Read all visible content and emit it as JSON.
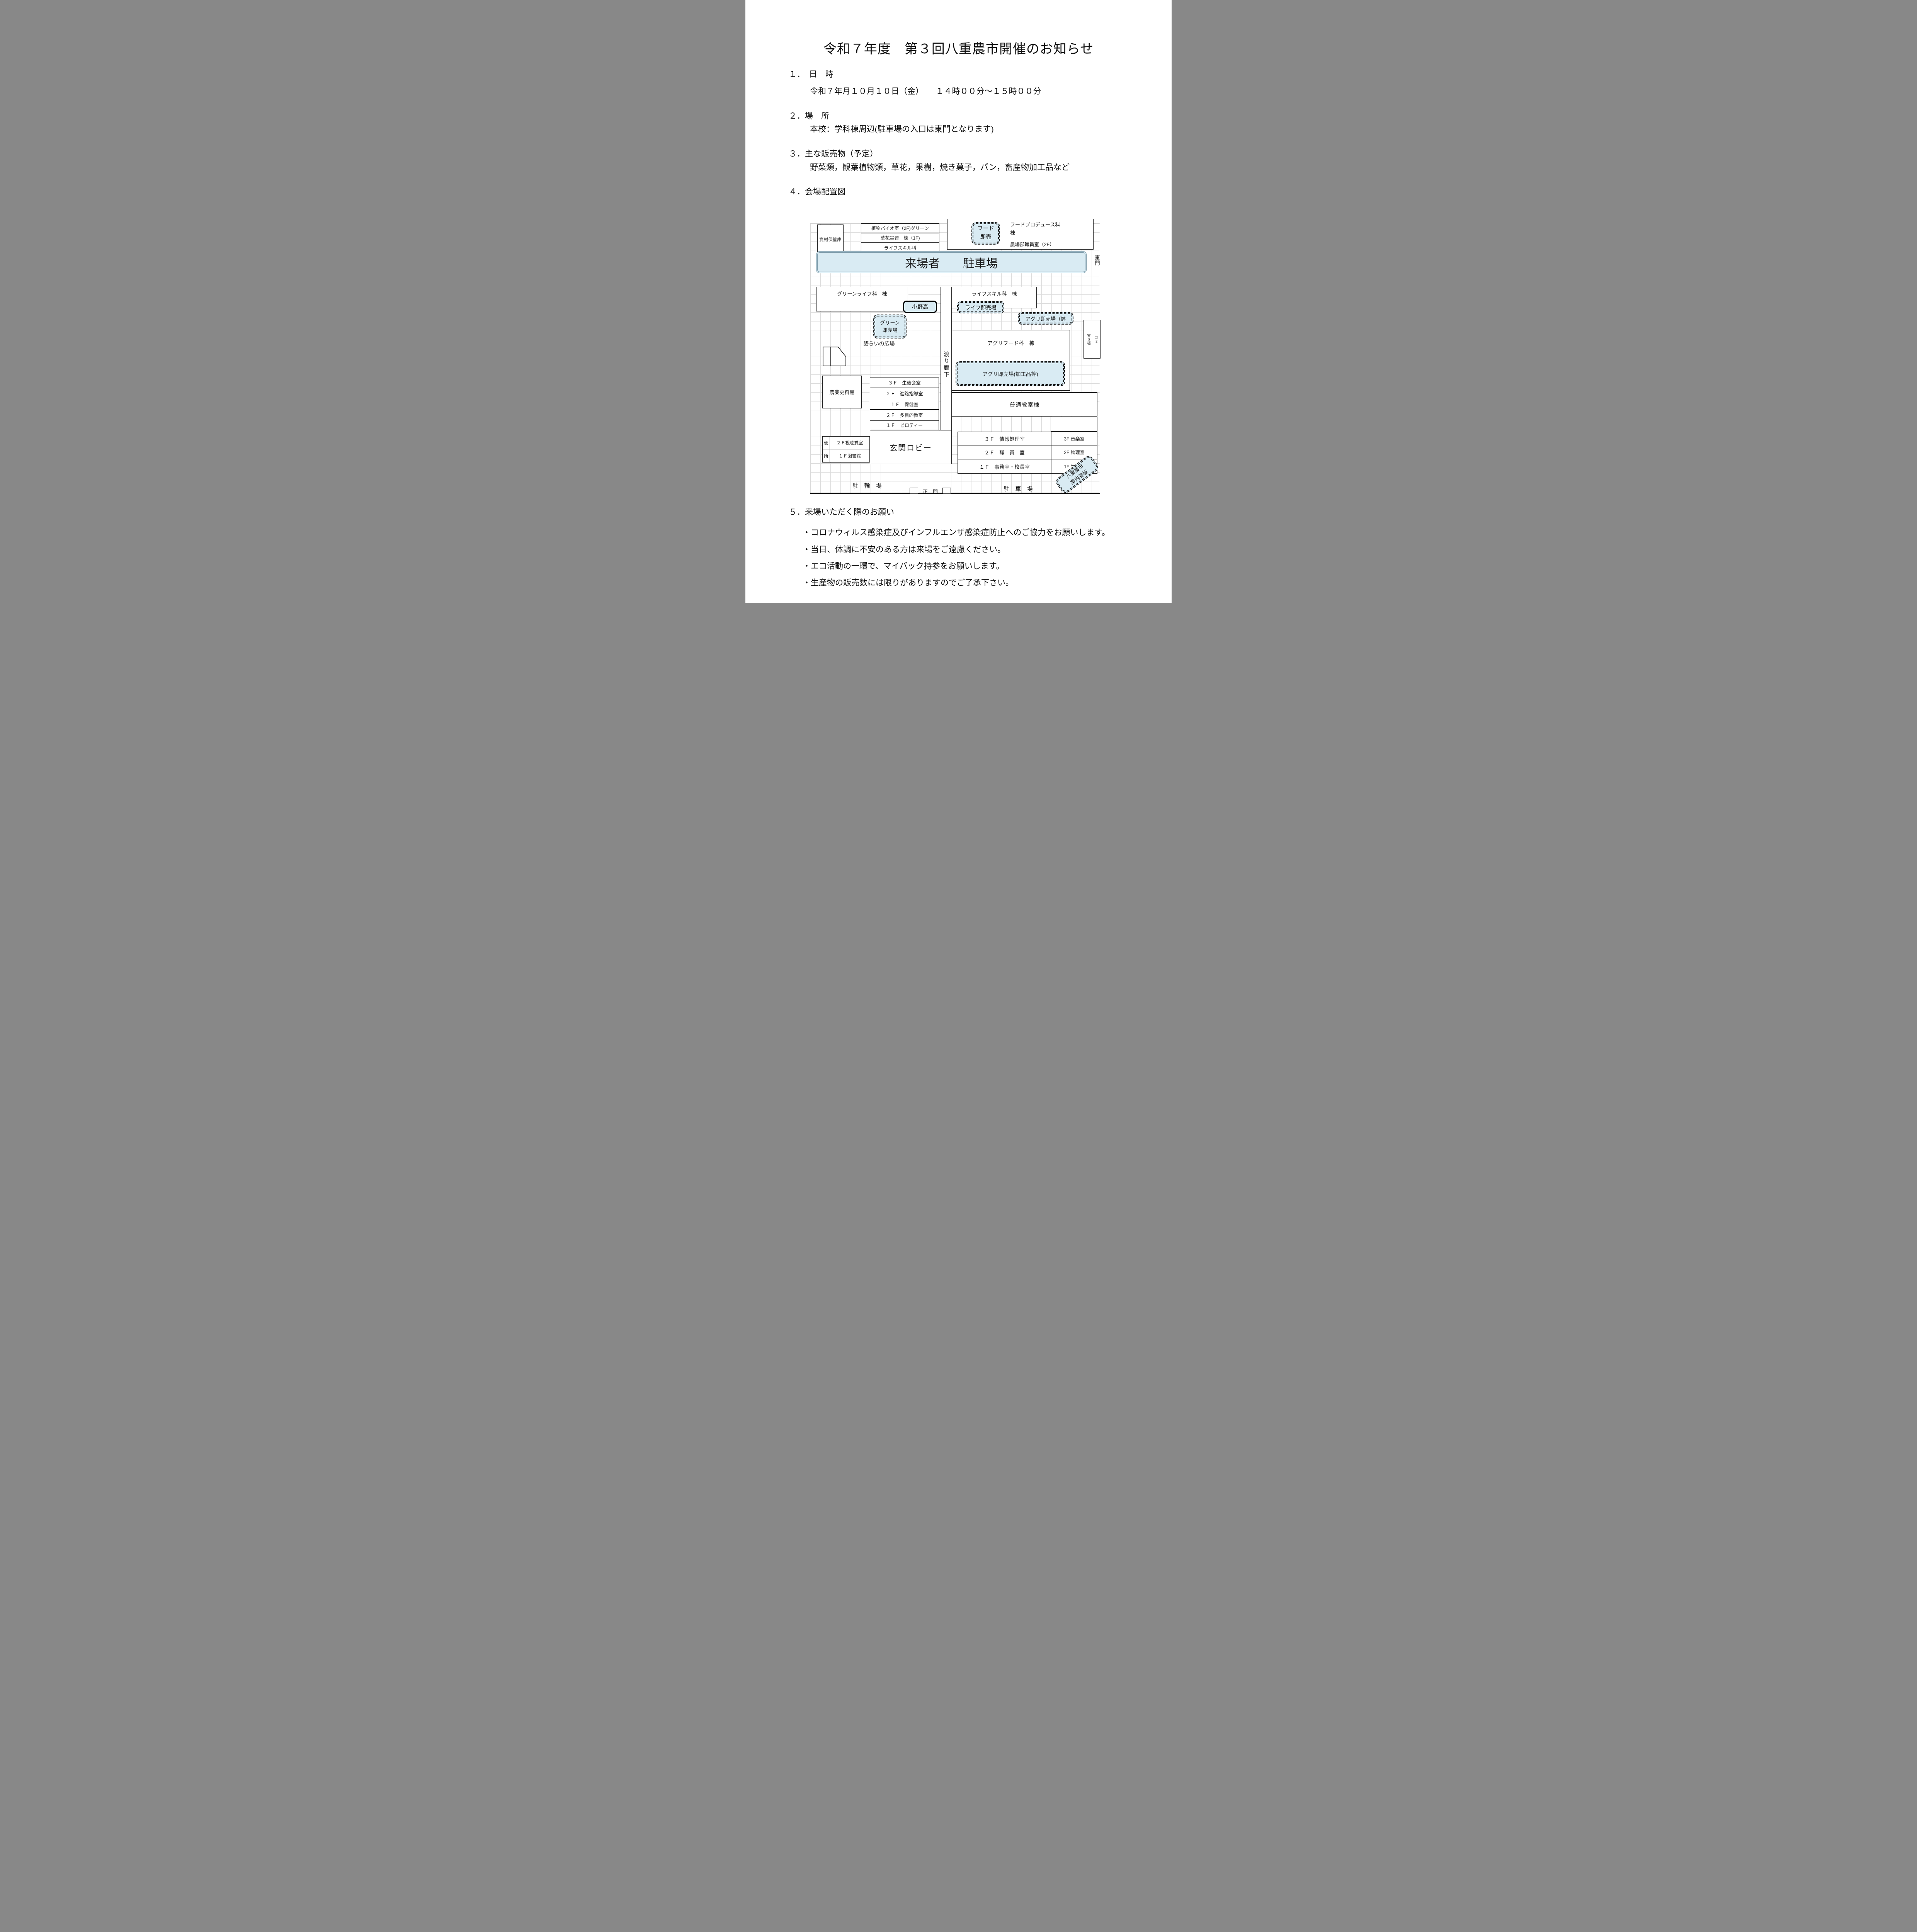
{
  "title": "令和７年度　第３回八重農市開催のお知らせ",
  "sections": {
    "s1_heading": "１．　日　時",
    "s1_body": "令和７年月１０月１０日（金）　　１４時００分～１５時００分",
    "s2_heading": "２．場　所",
    "s2_body": "本校：学科棟周辺(駐車場の入口は東門となります)",
    "s3_heading": "３．主な販売物（予定）",
    "s3_body": "野菜類，観葉植物類，草花，果樹，焼き菓子，パン，畜産物加工品など",
    "s4_heading": "４．会場配置図",
    "s5_heading": "５．来場いただく際のお願い",
    "s5_bullets": [
      "・コロナウィルス感染症及びインフルエンザ感染症防止へのご協力をお願いします。",
      "・当日、体調に不安のある方は来場をご遠慮ください。",
      "・エコ活動の一環で、マイバック持参をお願いします。",
      "・生産物の販売数には限りがありますのでご了承下さい。"
    ]
  },
  "map": {
    "materials_storage": "資材保管庫",
    "bio_room": "植物バイオ室（2F)グリーン",
    "flower_practice": "草花実習　棟（1F)",
    "lifeskill_dept": "ライフスキル科",
    "food_stall": "フード\n即売",
    "food_produce_bldg": "フードプロデュース科\n棟",
    "farm_office": "農場部職員室（2F）",
    "visitor_parking": "来場者　　駐車場",
    "east_gate": "東門",
    "greenlife_bldg": "グリーンライフ科　棟",
    "lifeskill_bldg": "ライフスキル科　棟",
    "onodaka": "小野高",
    "life_stall": "ライフ即売場",
    "agri_stall_pots": "アグリ即売場（鉢",
    "green_stall": "グリーン\n即売場",
    "plaza": "語らいの広場",
    "corridor": "渡り廊下",
    "agrifood_bldg": "アグリフード科　棟",
    "agri_stall_processed": "アグリ即売場(加工品等)",
    "garbage": "ゴミ\n置き場",
    "museum": "農業史料館",
    "mid_rows": [
      "３Ｆ　生徒会室",
      "２Ｆ　進路指導室",
      "１Ｆ　保健室",
      "２Ｆ　多目的教室",
      "１Ｆ　ピロティー"
    ],
    "regular_classroom": "普通教室棟",
    "toilet_top": "便",
    "toilet_bottom": "所",
    "av_room": "２Ｆ視聴覚室",
    "library": "１Ｆ図書館",
    "entrance_lobby": "玄関ロビー",
    "admin_rows": [
      "３Ｆ　情報処理室",
      "２Ｆ　職　員　室",
      "１Ｆ　事務室・校長室"
    ],
    "science_rows": [
      "3F 音楽室",
      "2F 物理室",
      "1F 生物室"
    ],
    "bicycle_parking": "駐　輪　場",
    "main_gate": "正　門",
    "parking": "駐　車　場",
    "signboard": "八重農市\n案内看板"
  },
  "colors": {
    "highlight": "#d9ebf3",
    "line": "#1f1f1f",
    "grid": "#dbdbdb"
  }
}
